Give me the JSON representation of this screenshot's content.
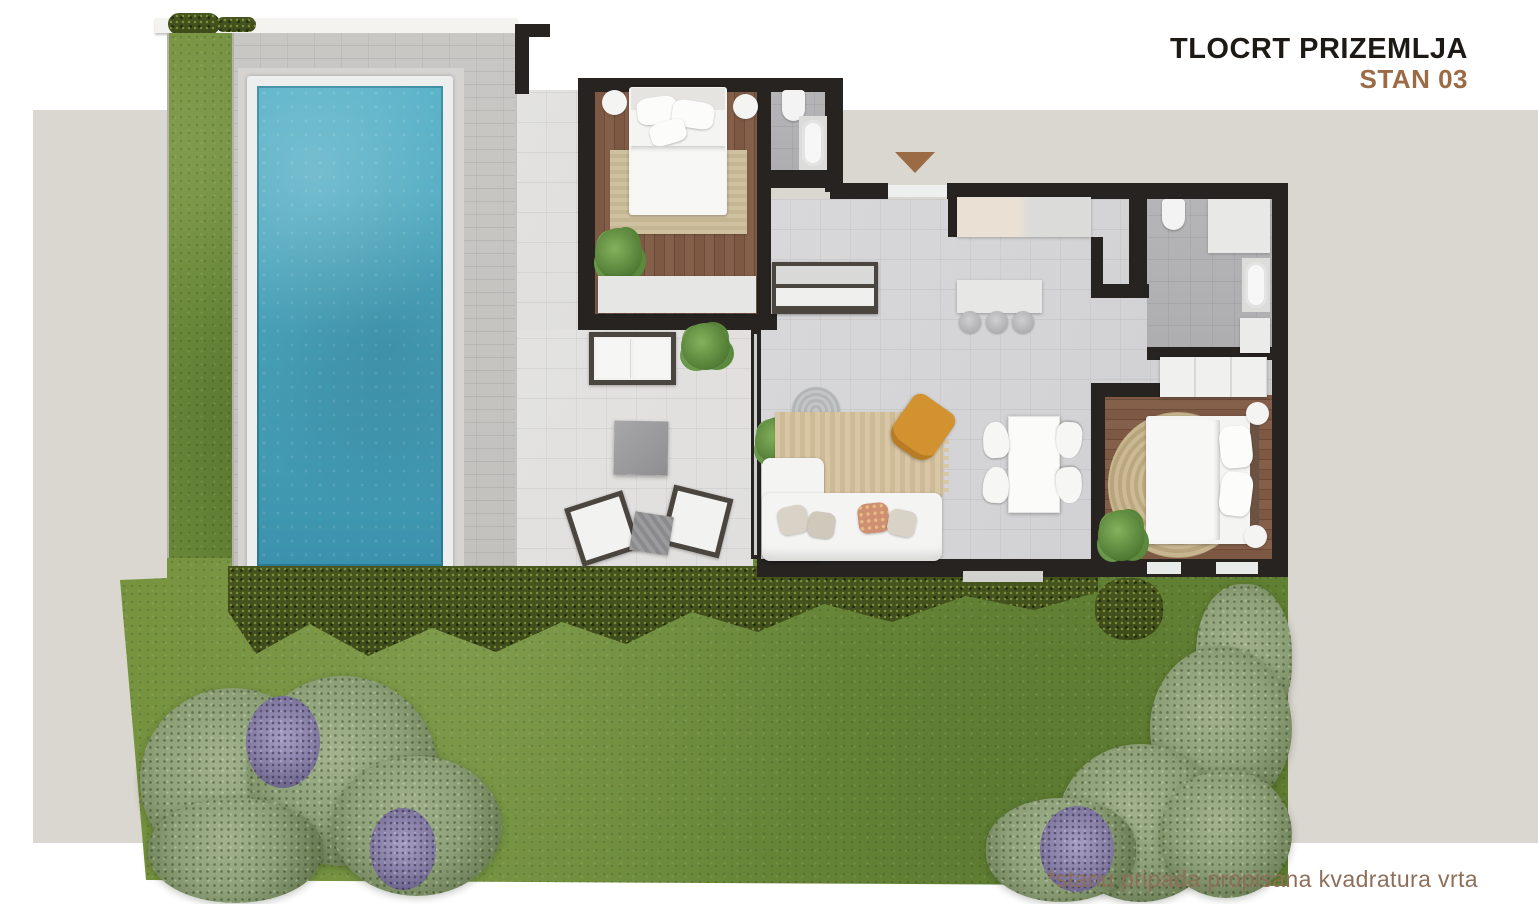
{
  "header": {
    "title": "TLOCRT PRIZEMLJA",
    "unit": "STAN 03"
  },
  "footnote": "*stanu pripada propisana kvadratura vrta",
  "markers": {
    "entrance_icon": "entrance-arrow"
  },
  "colors": {
    "band": "#dad7d0",
    "wall": "#272320",
    "tile": "#d3d3d5",
    "tilelight": "#e0dfdd",
    "bathtile": "#b5b5b7",
    "wood": "#7b5743",
    "deck": "#c9c7c4",
    "deckframe": "#d6d4d1",
    "coping": "#edefee",
    "watertop": "#58b2c8",
    "waterdeep": "#3c92ac",
    "grass": "#6f8e3c",
    "hedge": "#47561f",
    "bush": "#8da078",
    "lavender": "#847ca3",
    "rugbeige": "#d3c09e",
    "ruground": "#c8b58d",
    "furnwhite": "#f4f4f3",
    "orange": "#d1922f",
    "terracotta": "#cf8f72",
    "consoledark": "#4b4540",
    "titleink": "#1d1a16",
    "accent": "#9a6b44",
    "footink": "#8d6e58"
  }
}
